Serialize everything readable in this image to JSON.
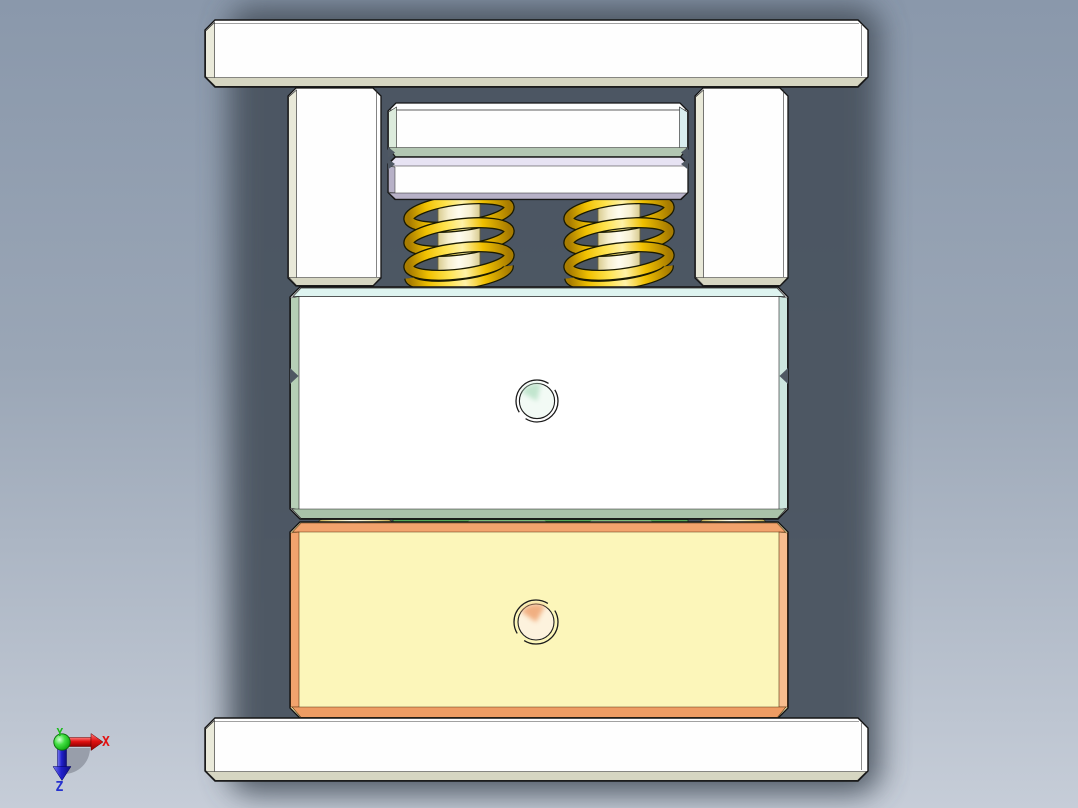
{
  "app": {
    "name": "CAD 3D viewport",
    "view": "front orthographic view of press-die / mold tool assembly"
  },
  "background": {
    "top": "#8a98ab",
    "mid": "#9aa6b6",
    "bottom": "#c6cdd8",
    "model_shadow": "#49525e"
  },
  "triad": {
    "x_label": "X",
    "y_label": "Y",
    "z_label": "Z",
    "x_color": "#e31212",
    "y_color": "#18bb18",
    "z_color": "#2531cf"
  },
  "parts": {
    "top_clamp_plate": {
      "label": "top clamp plate",
      "face": "#fefefe",
      "bevel_side": "#eaeada",
      "bevel_bottom": "#d6d6c2"
    },
    "left_guide_pillar": {
      "label": "left guide pillar",
      "face": "#fefefe",
      "bevel_side": "#e9e9d9",
      "bevel_bottom": "#d6d6c2"
    },
    "right_guide_pillar": {
      "label": "right guide pillar",
      "face": "#fefefe",
      "bevel_side": "#e9e9d9",
      "bevel_bottom": "#d6d6c2"
    },
    "punch_holder_plate": {
      "label": "punch holder plate",
      "face": "#fefefe",
      "bevel_left": "#dcebdc",
      "bevel_right": "#d9eef0",
      "bottom_face": "#b2c6b2"
    },
    "punch_backing_plate": {
      "label": "punch backing plate",
      "face": "#fefefe",
      "top_face": "#e7e3f3",
      "bevel_bottom": "#b7b1c7"
    },
    "springs": {
      "label": "compression springs (2)",
      "coil_bright": "#ffe34d",
      "coil": "#f0c000",
      "coil_dark": "#a87c00",
      "rod": "#fffdf0",
      "rod_edge": "#d8cb90"
    },
    "upper_die_block": {
      "label": "upper die block",
      "face": "#ffffff",
      "top_face": "#def4f0",
      "bevel_left": "#b6cfb6",
      "bevel_right": "#cde6df",
      "bottom_face": "#a9c2a9",
      "hole_tint": "#b9e2c8"
    },
    "stripper_strip": {
      "label": "stripper plate edge",
      "face": "#57a757"
    },
    "guide_pins": {
      "label": "guide pin ends",
      "face": "#fffdf0",
      "edge": "#c0a84e"
    },
    "lower_die_block": {
      "label": "lower die block",
      "face": "#fcf6ba",
      "top_bevel": "#f2a36d",
      "right_bevel": "#f7bd8e",
      "bottom_bevel": "#ee9c63",
      "hole_tint": "#f0a878"
    },
    "bottom_base_plate": {
      "label": "bottom base plate",
      "face": "#fefefe",
      "bevel_side": "#eaeada",
      "bevel_bottom": "#d6d6c2"
    }
  }
}
